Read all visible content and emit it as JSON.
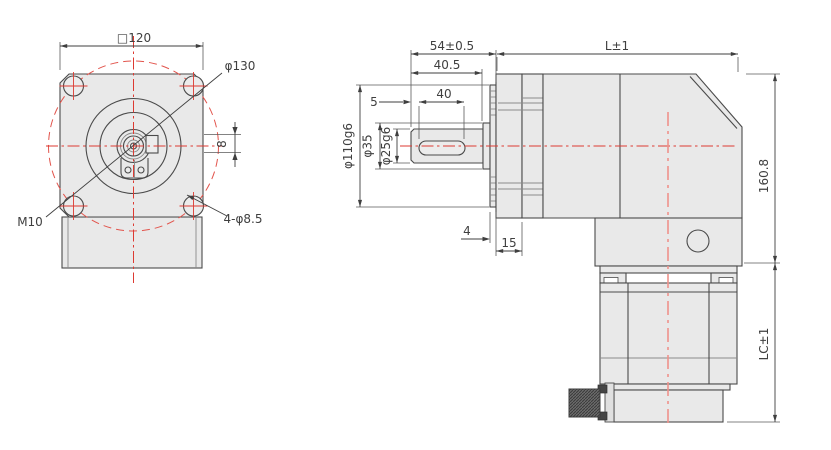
{
  "front_view": {
    "flange_width": "□120",
    "bolt_circle_dia": "φ130",
    "thread_spec": "M10",
    "mount_holes": "4-φ8.5",
    "key_width": "8"
  },
  "side_view": {
    "shaft_length": "54±0.5",
    "pilot_length": "40.5",
    "key_offset": "5",
    "key_length": "40",
    "pilot_dia": "φ110g6",
    "shoulder_dia": "φ35",
    "shaft_dia": "φ25g6",
    "plate_thickness": "4",
    "flange_thickness": "15",
    "body_length": "L±1",
    "body_height": "160.8",
    "motor_length": "LC±1"
  },
  "colors": {
    "outline": "#4a4a4a",
    "dimension_text": "#3f3f3f",
    "part_fill": "#e9e9e9",
    "centerline_red": "#dd3a32",
    "centerline_soft_red": "#ef928b",
    "connector_dark": "#5f5f5f",
    "background": "#ffffff"
  }
}
